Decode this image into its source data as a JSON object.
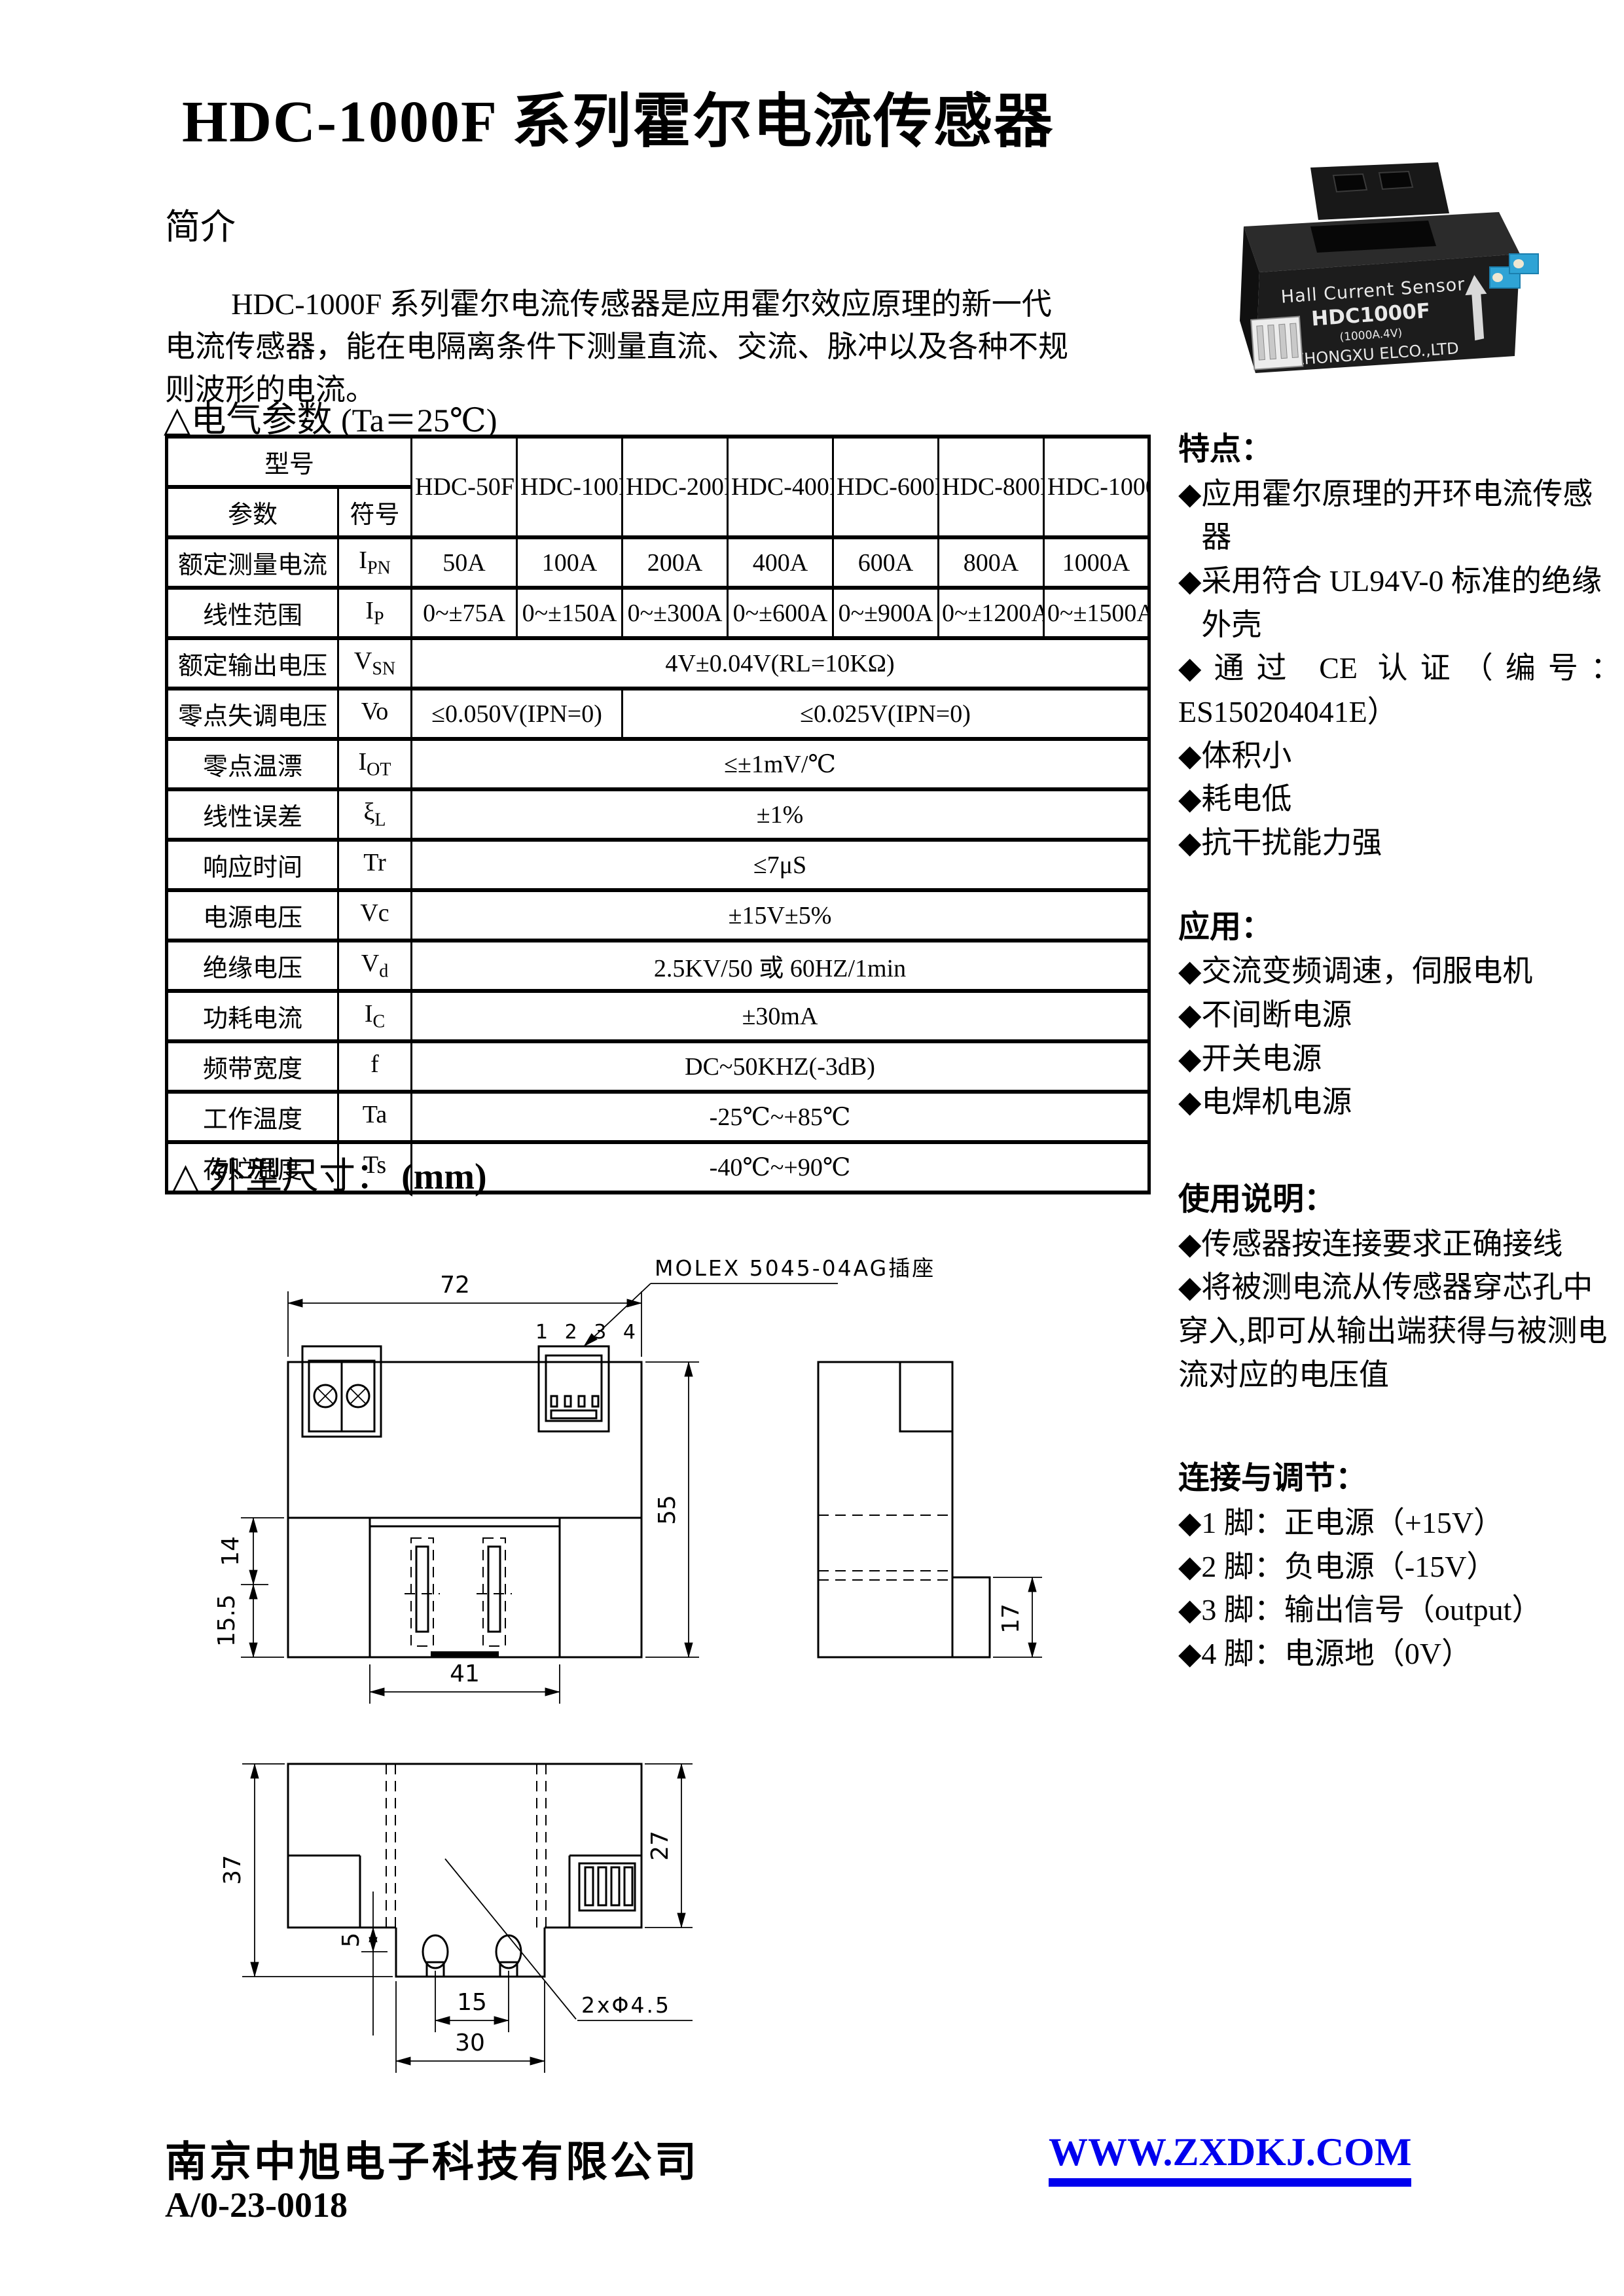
{
  "page_title": "HDC-1000F 系列霍尔电流传感器",
  "intro": {
    "heading": "简介",
    "body": "HDC-1000F 系列霍尔电流传感器是应用霍尔效应原理的新一代电流传感器，能在电隔离条件下测量直流、交流、脉冲以及各种不规则波形的电流。"
  },
  "product_photo": {
    "line1": "Hall Current Sensor",
    "model": "HDC1000F",
    "rating": "(1000A.4V)",
    "company": "ZHONGXU ELCO.,LTD"
  },
  "electrical": {
    "heading": "△电气参数",
    "heading_cond": "(Ta＝25℃)",
    "table": {
      "corner_model": "型号",
      "corner_param": "参数",
      "corner_symbol": "符号",
      "models": [
        "HDC-50F",
        "HDC-100F",
        "HDC-200F",
        "HDC-400F",
        "HDC-600F",
        "HDC-800F",
        "HDC-1000F"
      ],
      "rows": [
        {
          "param": "额定测量电流",
          "sym": "I",
          "sub": "PN",
          "v": [
            "50A",
            "100A",
            "200A",
            "400A",
            "600A",
            "800A",
            "1000A"
          ]
        },
        {
          "param": "线性范围",
          "sym": "I",
          "sub": "P",
          "v": [
            "0~±75A",
            "0~±150A",
            "0~±300A",
            "0~±600A",
            "0~±900A",
            "0~±1200A",
            "0~±1500A"
          ]
        },
        {
          "param": "额定输出电压",
          "sym": "V",
          "sub": "SN",
          "v": [
            "4V±0.04V(RL=10KΩ)"
          ]
        },
        {
          "param": "零点失调电压",
          "sym": "Vo",
          "sub": "",
          "v": [
            "≤0.050V(IPN=0)",
            "≤0.025V(IPN=0)"
          ]
        },
        {
          "param": "零点温漂",
          "sym": "I",
          "sub": "OT",
          "v": [
            "≤±1mV/℃"
          ]
        },
        {
          "param": "线性误差",
          "sym": "ξ",
          "sub": "L",
          "v": [
            "±1%"
          ]
        },
        {
          "param": "响应时间",
          "sym": "Tr",
          "sub": "",
          "v": [
            "≤7μS"
          ]
        },
        {
          "param": "电源电压",
          "sym": "Vc",
          "sub": "",
          "v": [
            "±15V±5%"
          ]
        },
        {
          "param": "绝缘电压",
          "sym": "V",
          "sub": "d",
          "v": [
            "2.5KV/50 或 60HZ/1min"
          ]
        },
        {
          "param": "功耗电流",
          "sym": "I",
          "sub": "C",
          "v": [
            "±30mA"
          ]
        },
        {
          "param": "频带宽度",
          "sym": "f",
          "sub": "",
          "v": [
            "DC~50KHZ(-3dB)"
          ]
        },
        {
          "param": "工作温度",
          "sym": "Ta",
          "sub": "",
          "v": [
            "-25℃~+85℃"
          ]
        },
        {
          "param": "存贮温度",
          "sym": "Ts",
          "sub": "",
          "v": [
            "-40℃~+90℃"
          ]
        }
      ]
    }
  },
  "sidebar": {
    "bullet": "◆",
    "features": {
      "heading": "特点：",
      "items": [
        "应用霍尔原理的开环电流传感器",
        "采用符合 UL94V-0 标准的绝缘外壳",
        "通过 CE 认证（编号：ES150204041E）",
        "体积小",
        "耗电低",
        "抗干扰能力强"
      ]
    },
    "applications": {
      "heading": "应用：",
      "items": [
        "交流变频调速，伺服电机",
        "不间断电源",
        "开关电源",
        "电焊机电源"
      ]
    },
    "usage": {
      "heading": "使用说明：",
      "items": [
        "传感器按连接要求正确接线",
        "将被测电流从传感器穿芯孔中穿入,即可从输出端获得与被测电流对应的电压值"
      ]
    },
    "connection": {
      "heading": "连接与调节：",
      "items": [
        "1 脚：正电源（+15V）",
        "2 脚：负电源（-15V）",
        "3 脚：输出信号（output）",
        "4 脚：电源地（0V）"
      ]
    }
  },
  "outline": {
    "heading": "△ 外型尺寸：",
    "unit": "(mm)",
    "connector_label": "MOLEX 5045-04AG插座",
    "pin_numbers": "1 2 3 4",
    "dims": {
      "width": "72",
      "height": "55",
      "upper_left": "14",
      "lower_left": "15.5",
      "core_width": "41",
      "side_tab": "17",
      "top_height": "37",
      "top_right": "27",
      "tab_offset": "5",
      "hole_pitch": "15",
      "tab_width": "30",
      "hole_callout": "2xΦ4.5"
    }
  },
  "footer": {
    "company": "南京中旭电子科技有限公司",
    "doc_code": "A/0-23-0018",
    "website": "WWW.ZXDKJ.COM"
  },
  "colors": {
    "link": "#0000ee",
    "ink": "#000000",
    "paper": "#ffffff"
  }
}
